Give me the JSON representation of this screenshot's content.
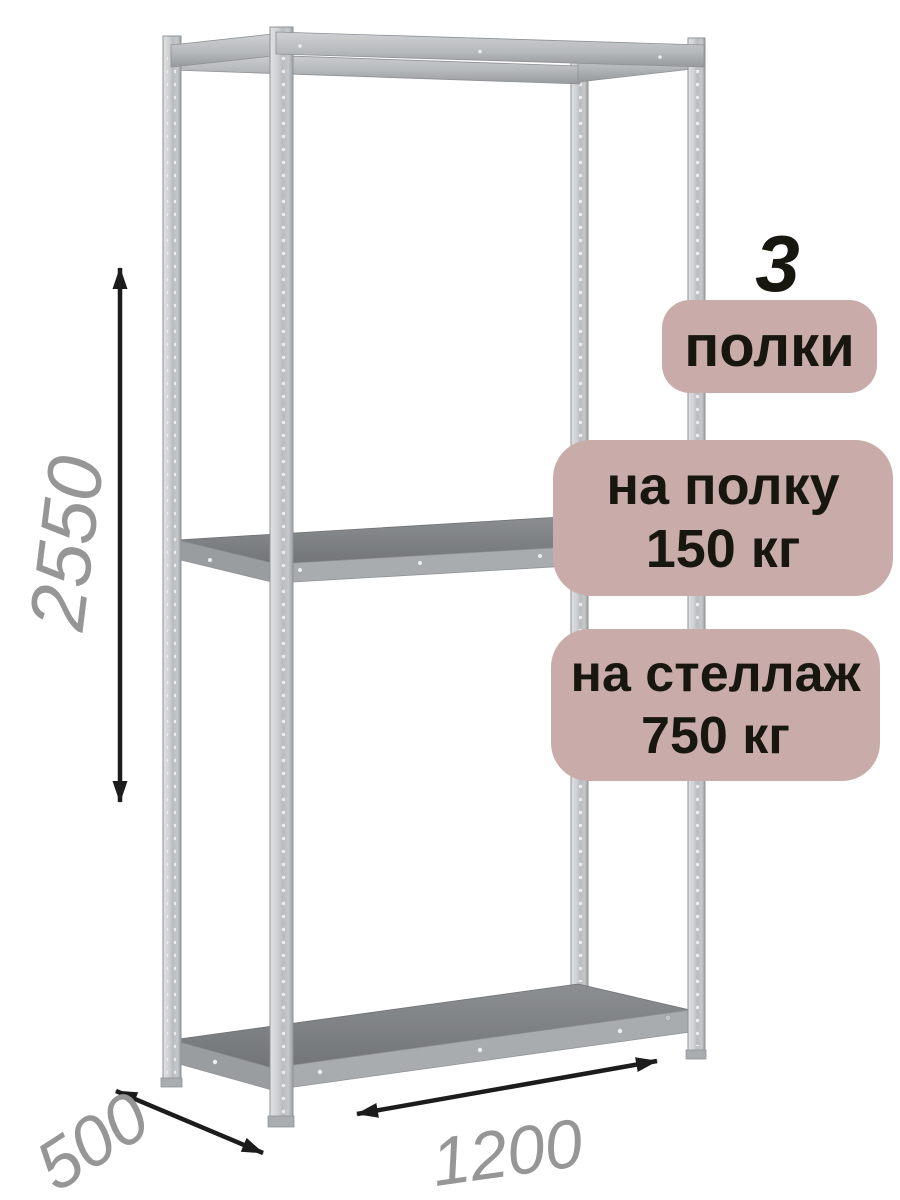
{
  "badges": {
    "count_number": "3",
    "count_label": "полки",
    "shelf_load": {
      "line1": "на полку",
      "line2": "150 кг"
    },
    "rack_load": {
      "line1": "на стеллаж",
      "line2": "750 кг"
    }
  },
  "dimensions": {
    "height": "2550",
    "depth": "500",
    "width": "1200"
  },
  "colors": {
    "badge_bg": "#c9acaa",
    "badge_text": "#17170f",
    "dimension_text": "#969696",
    "arrow": "#1c1c1c",
    "metal_light": "#e0e2e4",
    "metal_dark": "#9da0a3",
    "shelf_top": "#7d8083"
  }
}
